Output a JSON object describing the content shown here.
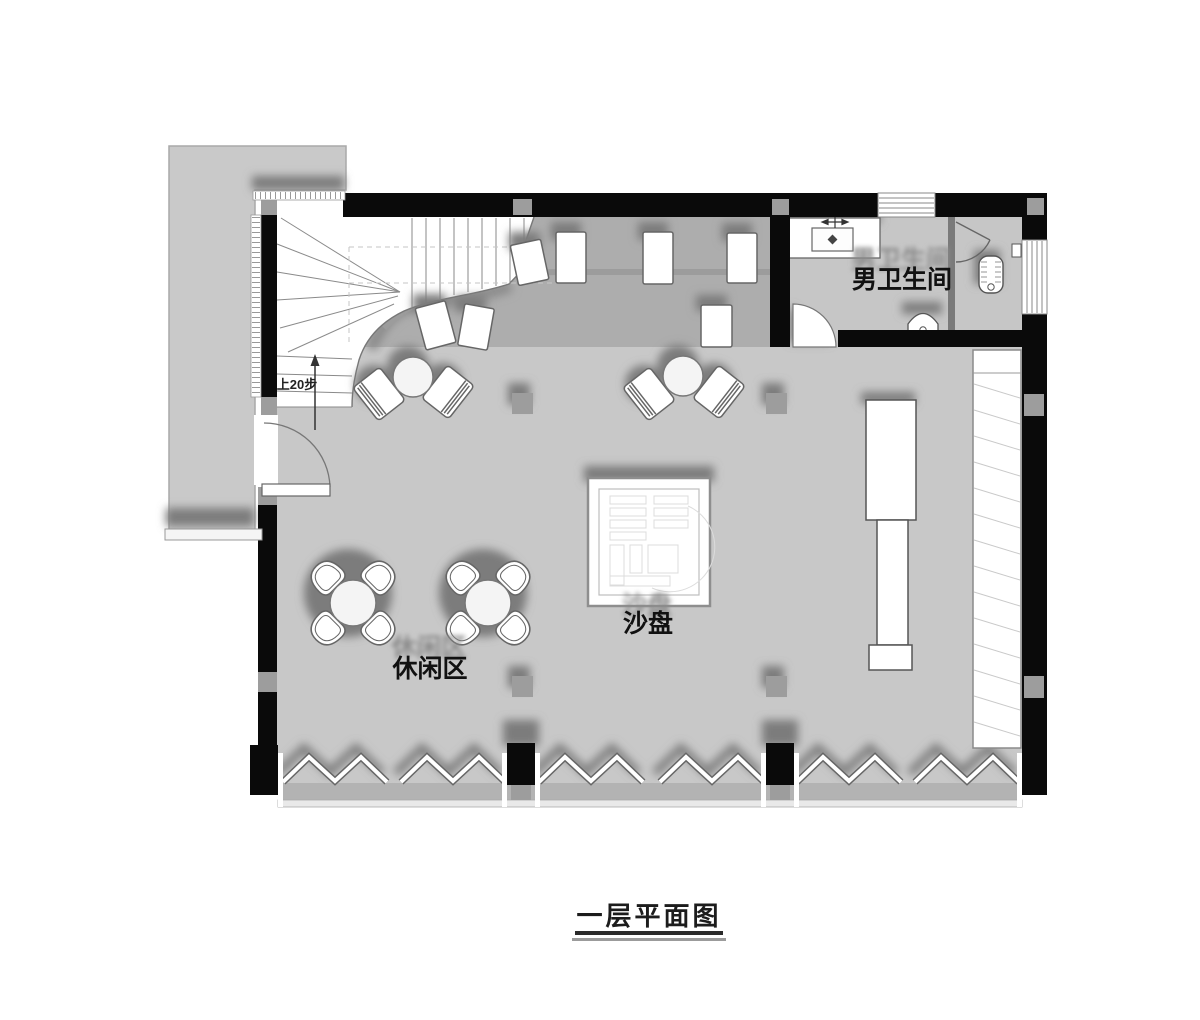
{
  "plan": {
    "title": "一层平面图",
    "labels": {
      "restroom": "男卫生间",
      "leisure_area": "休闲区",
      "sand_table": "沙盘",
      "stair_note": "上20步"
    },
    "colors": {
      "wall": "#0a0a0a",
      "floor": "#c8c8c8",
      "bar_floor": "#adadad",
      "terrace": "#c9c9c9",
      "column": "#9d9d9d",
      "shadow": "#7b7b7b",
      "fixture_outline": "#555555"
    }
  }
}
